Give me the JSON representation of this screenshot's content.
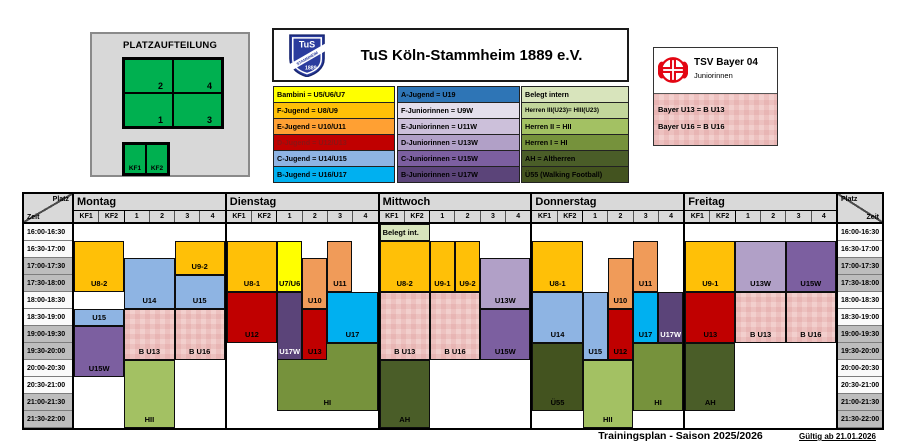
{
  "platzaufteilung": {
    "title": "PLATZAUFTEILUNG",
    "big_field_labels": [
      "2",
      "4",
      "1",
      "3"
    ],
    "small_field_labels": [
      "KF1",
      "KF2"
    ],
    "field_color": "#00B050"
  },
  "club": {
    "name": "TuS Köln-Stammheim 1889 e.V.",
    "logo_text": "TuS",
    "logo_year": "1889",
    "logo_band": "STAMMHEIM",
    "logo_color": "#2B3C9E"
  },
  "legend_jugend": [
    {
      "label": "Bambini = U5/U6/U7",
      "color": "#FFFF00"
    },
    {
      "label": "F-Jugend = U8/U9",
      "color": "#FFC007"
    },
    {
      "label": "E-Jugend = U10/U11",
      "color": "#FFA033"
    },
    {
      "label": "D-Jugend = U12/U13",
      "color": "#C00000",
      "text": "#8B1414"
    },
    {
      "label": "C-Jugend = U14/U15",
      "color": "#8EB4E3"
    },
    {
      "label": "B-Jugend = U16/U17",
      "color": "#00B0F0"
    }
  ],
  "legend_juniorinnen": [
    {
      "label": "A-Jugend = U19",
      "color": "#2E75B6"
    },
    {
      "label": "F-Juniorinnen = U9W",
      "color": "#E4DFEC"
    },
    {
      "label": "E-Juniorinnen = U11W",
      "color": "#CCC0DA"
    },
    {
      "label": "D-Juniorinnen = U13W",
      "color": "#B1A0C7"
    },
    {
      "label": "C-Juniorinnen = U15W",
      "color": "#7C5FA0"
    },
    {
      "label": "B-Juniorinnen = U17W",
      "color": "#5B4479"
    }
  ],
  "legend_herren": [
    {
      "label": "Belegt intern",
      "color": "#D8E4BC"
    },
    {
      "label": "Herren III(U23)= HIII(U23)",
      "color": "#C2D69B"
    },
    {
      "label": "Herren II = HII",
      "color": "#A3C163"
    },
    {
      "label": "Herren I = HI",
      "color": "#76923C"
    },
    {
      "label": "AH = Altherren",
      "color": "#4A5D28"
    },
    {
      "label": "Ü55 (Walking Football)",
      "color": "#43531F"
    }
  ],
  "bayer": {
    "title": "TSV Bayer 04",
    "subtitle": "Juniorinnen",
    "rows": [
      "Bayer U13 = B U13",
      "Bayer U16 = B U16"
    ],
    "brand_color": "#E30613"
  },
  "schedule": {
    "corner": {
      "platz": "Platz",
      "zeit": "Zeit"
    },
    "columns": [
      "KF1",
      "KF2",
      "1",
      "2",
      "3",
      "4"
    ],
    "times": [
      "16:00-16:30",
      "16:30-17:00",
      "17:00-17:30",
      "17:30-18:00",
      "18:00-18:30",
      "18:30-19:00",
      "19:00-19:30",
      "19:30-20:00",
      "20:00-20:30",
      "20:30-21:00",
      "21:00-21:30",
      "21:30-22:00"
    ],
    "colors": {
      "golden": "#FFC007",
      "yellow": "#FFFF00",
      "salmon": "#F09B59",
      "red": "#C00000",
      "lblue": "#8EB4E3",
      "cyan": "#00B0F0",
      "lpurple": "#B1A0C7",
      "mpurple": "#7C5FA0",
      "dpurple": "#5B4479",
      "pink": "pattern",
      "gbelegt": "#D8E4BC",
      "ghii": "#A3C163",
      "ghi": "#76923C",
      "gah": "#4A5D28",
      "gu55": "#43531F"
    },
    "days": [
      {
        "name": "Montag",
        "blocks": [
          {
            "label": "U8-2",
            "col": 0,
            "span": 2,
            "row": 1,
            "rows": 3,
            "color": "golden"
          },
          {
            "label": "U15",
            "col": 0,
            "span": 2,
            "row": 5,
            "rows": 1,
            "color": "lblue"
          },
          {
            "label": "U15W",
            "col": 0,
            "span": 2,
            "row": 6,
            "rows": 3,
            "color": "mpurple"
          },
          {
            "label": "U14",
            "col": 2,
            "span": 2,
            "row": 2,
            "rows": 3,
            "color": "lblue"
          },
          {
            "label": "B U13",
            "col": 2,
            "span": 2,
            "row": 5,
            "rows": 3,
            "color": "pink"
          },
          {
            "label": "HII",
            "col": 2,
            "span": 2,
            "row": 8,
            "rows": 4,
            "color": "ghii"
          },
          {
            "label": "U9-2",
            "col": 4,
            "span": 2,
            "row": 1,
            "rows": 2,
            "color": "golden"
          },
          {
            "label": "U15",
            "col": 4,
            "span": 2,
            "row": 3,
            "rows": 2,
            "color": "lblue"
          },
          {
            "label": "B U16",
            "col": 4,
            "span": 2,
            "row": 5,
            "rows": 3,
            "color": "pink"
          }
        ]
      },
      {
        "name": "Dienstag",
        "blocks": [
          {
            "label": "U8-1",
            "col": 0,
            "span": 2,
            "row": 1,
            "rows": 3,
            "color": "golden"
          },
          {
            "label": "U12",
            "col": 0,
            "span": 2,
            "row": 4,
            "rows": 3,
            "color": "red"
          },
          {
            "label": "U7/U6",
            "col": 2,
            "span": 1,
            "row": 1,
            "rows": 3,
            "color": "yellow"
          },
          {
            "label": "HI",
            "col": 2,
            "span": 4,
            "row": 7,
            "rows": 4,
            "color": "ghi",
            "z": 1
          },
          {
            "label": "U17W",
            "col": 2,
            "span": 1,
            "row": 4,
            "rows": 4,
            "color": "dpurple",
            "text": "#fff",
            "z": 2
          },
          {
            "label": "U10",
            "col": 3,
            "span": 1,
            "row": 2,
            "rows": 3,
            "color": "salmon"
          },
          {
            "label": "U13",
            "col": 3,
            "span": 1,
            "row": 5,
            "rows": 3,
            "color": "red",
            "z": 2
          },
          {
            "label": "U11",
            "col": 4,
            "span": 1,
            "row": 1,
            "rows": 3,
            "color": "salmon"
          },
          {
            "label": "U17",
            "col": 4,
            "span": 2,
            "row": 4,
            "rows": 3,
            "color": "cyan"
          }
        ]
      },
      {
        "name": "Mittwoch",
        "blocks": [
          {
            "label": "Belegt int.",
            "col": 0,
            "span": 2,
            "row": 0,
            "rows": 1,
            "color": "gbelegt",
            "align": "left"
          },
          {
            "label": "U8-2",
            "col": 0,
            "span": 2,
            "row": 1,
            "rows": 3,
            "color": "golden"
          },
          {
            "label": "B U13",
            "col": 0,
            "span": 2,
            "row": 4,
            "rows": 4,
            "color": "pink"
          },
          {
            "label": "AH",
            "col": 0,
            "span": 2,
            "row": 8,
            "rows": 4,
            "color": "gah"
          },
          {
            "label": "U9-1",
            "col": 2,
            "span": 1,
            "row": 1,
            "rows": 3,
            "color": "golden"
          },
          {
            "label": "U9-2",
            "col": 3,
            "span": 1,
            "row": 1,
            "rows": 3,
            "color": "golden"
          },
          {
            "label": "B U16",
            "col": 2,
            "span": 2,
            "row": 4,
            "rows": 4,
            "color": "pink"
          },
          {
            "label": "U13W",
            "col": 4,
            "span": 2,
            "row": 2,
            "rows": 3,
            "color": "lpurple"
          },
          {
            "label": "U15W",
            "col": 4,
            "span": 2,
            "row": 5,
            "rows": 3,
            "color": "mpurple"
          }
        ]
      },
      {
        "name": "Donnerstag",
        "blocks": [
          {
            "label": "U8-1",
            "col": 0,
            "span": 2,
            "row": 1,
            "rows": 3,
            "color": "golden"
          },
          {
            "label": "U14",
            "col": 0,
            "span": 2,
            "row": 4,
            "rows": 3,
            "color": "lblue"
          },
          {
            "label": "Ü55",
            "col": 0,
            "span": 2,
            "row": 7,
            "rows": 4,
            "color": "gu55"
          },
          {
            "label": "U15",
            "col": 2,
            "span": 1,
            "row": 4,
            "rows": 4,
            "color": "lblue"
          },
          {
            "label": "HII",
            "col": 2,
            "span": 2,
            "row": 8,
            "rows": 4,
            "color": "ghii"
          },
          {
            "label": "U10",
            "col": 3,
            "span": 1,
            "row": 2,
            "rows": 3,
            "color": "salmon"
          },
          {
            "label": "U12",
            "col": 3,
            "span": 1,
            "row": 5,
            "rows": 3,
            "color": "red"
          },
          {
            "label": "U11",
            "col": 4,
            "span": 1,
            "row": 1,
            "rows": 3,
            "color": "salmon"
          },
          {
            "label": "U17",
            "col": 4,
            "span": 1,
            "row": 4,
            "rows": 3,
            "color": "cyan"
          },
          {
            "label": "U17W",
            "col": 5,
            "span": 1,
            "row": 4,
            "rows": 3,
            "color": "dpurple",
            "text": "#fff"
          },
          {
            "label": "HI",
            "col": 4,
            "span": 2,
            "row": 7,
            "rows": 4,
            "color": "ghi"
          }
        ]
      },
      {
        "name": "Freitag",
        "blocks": [
          {
            "label": "U9-1",
            "col": 0,
            "span": 2,
            "row": 1,
            "rows": 3,
            "color": "golden"
          },
          {
            "label": "U13",
            "col": 0,
            "span": 2,
            "row": 4,
            "rows": 3,
            "color": "red"
          },
          {
            "label": "AH",
            "col": 0,
            "span": 2,
            "row": 7,
            "rows": 4,
            "color": "gah"
          },
          {
            "label": "U13W",
            "col": 2,
            "span": 2,
            "row": 1,
            "rows": 3,
            "color": "lpurple"
          },
          {
            "label": "B U13",
            "col": 2,
            "span": 2,
            "row": 4,
            "rows": 3,
            "color": "pink"
          },
          {
            "label": "U15W",
            "col": 4,
            "span": 2,
            "row": 1,
            "rows": 3,
            "color": "mpurple"
          },
          {
            "label": "B U16",
            "col": 4,
            "span": 2,
            "row": 4,
            "rows": 3,
            "color": "pink"
          }
        ]
      }
    ]
  },
  "footer": {
    "title": "Trainingsplan - Saison 2025/2026",
    "valid": "Gültig ab 21.01.2026"
  }
}
